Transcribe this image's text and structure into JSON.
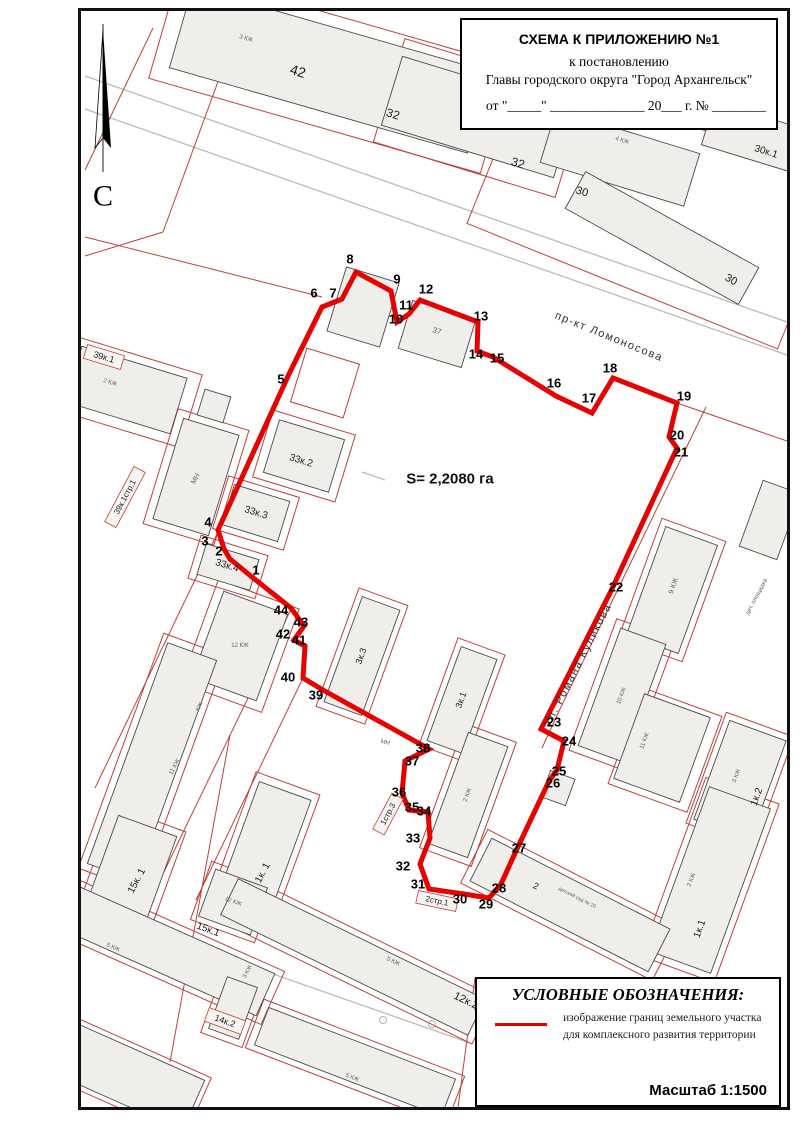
{
  "title_box": {
    "line1": "СХЕМА К ПРИЛОЖЕНИЮ №1",
    "line2": "к постановлению",
    "line3": "Главы городского округа \"Город Архангельск\"",
    "line4": "от \"_____\" ______________ 20___ г. № ________"
  },
  "legend": {
    "heading": "УСЛОВНЫЕ ОБОЗНАЧЕНИЯ:",
    "line1": "изображение границ земельного участка",
    "line2": "для комплексного развития территории",
    "scale": "Масштаб 1:1500"
  },
  "map": {
    "colors": {
      "boundary": "#e60000",
      "parcel": "#c0403a",
      "building_fill": "#f0eeea",
      "street_line": "#bdbab3"
    },
    "area_label": {
      "t": "S= 2,2080 га",
      "x": 450,
      "y": 479
    },
    "north": {
      "label": "С",
      "label_x": 103,
      "label_y": 196,
      "line": [
        103,
        24,
        103,
        172
      ],
      "blade_fill": [
        [
          103,
          30
        ],
        [
          111,
          148
        ],
        [
          103,
          138
        ]
      ],
      "blade_out": [
        [
          103,
          30
        ],
        [
          95,
          148
        ],
        [
          103,
          138
        ]
      ]
    },
    "streets": [
      {
        "t": "пр-кт Ломоносова",
        "x": 609,
        "y": 337,
        "r": 22
      },
      {
        "t": "Ул. Романа Куликова",
        "x": 578,
        "y": 665,
        "r": -63
      }
    ],
    "boundary": {
      "points": [
        [
          252,
          577
        ],
        [
          230,
          559
        ],
        [
          224,
          549
        ],
        [
          218,
          530
        ],
        [
          289,
          374
        ],
        [
          322,
          307
        ],
        [
          342,
          299
        ],
        [
          356,
          272
        ],
        [
          391,
          291
        ],
        [
          397,
          322
        ],
        [
          409,
          314
        ],
        [
          420,
          300
        ],
        [
          478,
          322
        ],
        [
          477,
          351
        ],
        [
          493,
          357
        ],
        [
          556,
          396
        ],
        [
          592,
          413
        ],
        [
          613,
          378
        ],
        [
          677,
          403
        ],
        [
          669,
          437
        ],
        [
          677,
          448
        ],
        [
          611,
          591
        ],
        [
          541,
          729
        ],
        [
          564,
          741
        ],
        [
          557,
          770
        ],
        [
          549,
          781
        ],
        [
          516,
          851
        ],
        [
          501,
          884
        ],
        [
          489,
          898
        ],
        [
          464,
          894
        ],
        [
          429,
          889
        ],
        [
          420,
          864
        ],
        [
          430,
          838
        ],
        [
          428,
          812
        ],
        [
          409,
          810
        ],
        [
          402,
          793
        ],
        [
          405,
          761
        ],
        [
          429,
          749
        ],
        [
          323,
          690
        ],
        [
          303,
          678
        ],
        [
          305,
          646
        ],
        [
          294,
          640
        ],
        [
          304,
          626
        ],
        [
          291,
          608
        ]
      ]
    },
    "vertices": [
      [
        "1",
        256,
        570
      ],
      [
        "2",
        219,
        551
      ],
      [
        "3",
        205,
        541
      ],
      [
        "4",
        208,
        522
      ],
      [
        "5",
        281,
        379
      ],
      [
        "6",
        314,
        293
      ],
      [
        "7",
        333,
        293
      ],
      [
        "8",
        350,
        259
      ],
      [
        "9",
        397,
        279
      ],
      [
        "10",
        396,
        319
      ],
      [
        "11",
        406,
        305
      ],
      [
        "12",
        426,
        289
      ],
      [
        "13",
        481,
        316
      ],
      [
        "14",
        476,
        354
      ],
      [
        "15",
        497,
        358
      ],
      [
        "16",
        554,
        383
      ],
      [
        "17",
        589,
        398
      ],
      [
        "18",
        610,
        368
      ],
      [
        "19",
        684,
        396
      ],
      [
        "20",
        677,
        435
      ],
      [
        "21",
        681,
        452
      ],
      [
        "22",
        616,
        587
      ],
      [
        "23",
        554,
        722
      ],
      [
        "24",
        569,
        741
      ],
      [
        "25",
        559,
        771
      ],
      [
        "26",
        553,
        783
      ],
      [
        "27",
        519,
        848
      ],
      [
        "28",
        499,
        888
      ],
      [
        "29",
        486,
        904
      ],
      [
        "30",
        460,
        899
      ],
      [
        "31",
        418,
        884
      ],
      [
        "32",
        403,
        866
      ],
      [
        "33",
        413,
        838
      ],
      [
        "34",
        424,
        811
      ],
      [
        "35",
        412,
        807
      ],
      [
        "36",
        399,
        792
      ],
      [
        "37",
        412,
        761
      ],
      [
        "38",
        423,
        748
      ],
      [
        "39",
        316,
        695
      ],
      [
        "40",
        288,
        677
      ],
      [
        "41",
        299,
        640
      ],
      [
        "42",
        283,
        634
      ],
      [
        "43",
        301,
        622
      ],
      [
        "44",
        281,
        610
      ]
    ],
    "buildings": [
      [
        330,
        70,
        310,
        84,
        16
      ],
      [
        478,
        117,
        180,
        72,
        17
      ],
      [
        620,
        158,
        150,
        55,
        17
      ],
      [
        662,
        238,
        198,
        42,
        29
      ],
      [
        763,
        140,
        115,
        45,
        17
      ],
      [
        126,
        390,
        110,
        58,
        17
      ],
      [
        196,
        477,
        58,
        105,
        17
      ],
      [
        214,
        406,
        27,
        27,
        17
      ],
      [
        363,
        307,
        55,
        67,
        17
      ],
      [
        437,
        334,
        66,
        50,
        17
      ],
      [
        304,
        456,
        68,
        55,
        17
      ],
      [
        256,
        513,
        58,
        42,
        17
      ],
      [
        228,
        567,
        55,
        32,
        17
      ],
      [
        240,
        646,
        68,
        92,
        20
      ],
      [
        362,
        656,
        40,
        112,
        20
      ],
      [
        462,
        700,
        38,
        100,
        20
      ],
      [
        468,
        795,
        42,
        118,
        20
      ],
      [
        152,
        762,
        52,
        235,
        20
      ],
      [
        128,
        880,
        62,
        115,
        20
      ],
      [
        263,
        852,
        55,
        130,
        20
      ],
      [
        233,
        902,
        55,
        50,
        20
      ],
      [
        165,
        950,
        220,
        46,
        24
      ],
      [
        125,
        1075,
        150,
        55,
        24
      ],
      [
        353,
        957,
        275,
        40,
        26
      ],
      [
        355,
        1062,
        200,
        40,
        21
      ],
      [
        233,
        1008,
        32,
        55,
        20
      ],
      [
        672,
        590,
        55,
        115,
        20
      ],
      [
        622,
        695,
        48,
        125,
        20
      ],
      [
        662,
        748,
        70,
        90,
        20
      ],
      [
        740,
        780,
        60,
        105,
        20
      ],
      [
        710,
        880,
        65,
        175,
        20
      ],
      [
        570,
        905,
        200,
        48,
        27
      ],
      [
        558,
        788,
        26,
        28,
        20
      ],
      [
        770,
        520,
        40,
        70,
        20
      ]
    ],
    "parcels": [
      [
        330,
        72,
        345,
        112,
        16
      ],
      [
        480,
        118,
        190,
        108,
        17
      ],
      [
        655,
        205,
        335,
        175,
        22
      ],
      [
        128,
        392,
        132,
        76,
        17
      ],
      [
        304,
        456,
        86,
        70,
        17
      ],
      [
        256,
        513,
        74,
        55,
        17
      ],
      [
        228,
        567,
        70,
        45,
        17
      ],
      [
        325,
        383,
        55,
        56,
        17
      ],
      [
        196,
        477,
        74,
        120,
        17
      ],
      [
        240,
        646,
        86,
        110,
        20
      ],
      [
        362,
        656,
        52,
        126,
        20
      ],
      [
        462,
        700,
        50,
        114,
        20
      ],
      [
        468,
        795,
        55,
        132,
        20
      ],
      [
        152,
        762,
        66,
        250,
        20
      ],
      [
        128,
        880,
        76,
        130,
        20
      ],
      [
        263,
        852,
        68,
        146,
        20
      ],
      [
        233,
        902,
        68,
        62,
        20
      ],
      [
        165,
        950,
        236,
        58,
        24
      ],
      [
        353,
        957,
        290,
        52,
        26
      ],
      [
        355,
        1062,
        215,
        52,
        21
      ],
      [
        233,
        1008,
        44,
        68,
        20
      ],
      [
        672,
        590,
        68,
        128,
        20
      ],
      [
        622,
        695,
        62,
        140,
        20
      ],
      [
        665,
        750,
        84,
        102,
        20
      ],
      [
        740,
        780,
        72,
        118,
        20
      ],
      [
        710,
        880,
        78,
        190,
        20
      ],
      [
        570,
        905,
        215,
        60,
        27
      ],
      [
        125,
        1075,
        160,
        65,
        24
      ]
    ],
    "red_lines": [
      [
        85,
        170,
        153,
        28
      ],
      [
        163,
        232,
        231,
        46
      ],
      [
        85,
        256,
        163,
        232
      ],
      [
        85,
        237,
        322,
        297
      ],
      [
        677,
        403,
        787,
        441
      ],
      [
        706,
        407,
        560,
        709
      ],
      [
        560,
        709,
        542,
        748
      ],
      [
        218,
        532,
        95,
        788
      ],
      [
        291,
        609,
        160,
        880
      ],
      [
        303,
        678,
        196,
        900
      ],
      [
        230,
        735,
        170,
        1062
      ],
      [
        475,
        978,
        458,
        1108
      ]
    ],
    "grey_lines": [
      [
        85,
        76,
        787,
        322
      ],
      [
        85,
        109,
        787,
        355
      ],
      [
        85,
        908,
        470,
        1043
      ],
      [
        362,
        472,
        385,
        480
      ]
    ],
    "marks": [
      [
        383,
        1020
      ],
      [
        432,
        1024
      ],
      [
        478,
        1008
      ]
    ],
    "labels": [
      [
        "42",
        298,
        71,
        17,
        14,
        "b"
      ],
      [
        "32",
        393,
        114,
        17,
        12,
        "b"
      ],
      [
        "32",
        518,
        163,
        17,
        12,
        "b"
      ],
      [
        "30",
        582,
        192,
        17,
        11,
        "b"
      ],
      [
        "30",
        731,
        280,
        29,
        11,
        "b"
      ],
      [
        "30к.1",
        766,
        152,
        17,
        10,
        "b"
      ],
      [
        "4 КЖ",
        622,
        141,
        17,
        6,
        "g"
      ],
      [
        "3 КЖ",
        246,
        39,
        16,
        6,
        "g"
      ],
      [
        "2 КЖ",
        110,
        383,
        17,
        6,
        "g"
      ],
      [
        "39к.1",
        104,
        357,
        17,
        9,
        "x"
      ],
      [
        "39к.1стр.1",
        125,
        497,
        -62,
        8,
        "x"
      ],
      [
        "МН",
        196,
        479,
        -62,
        7,
        "g"
      ],
      [
        "33к.2",
        301,
        461,
        17,
        10,
        "b"
      ],
      [
        "33к.3",
        256,
        513,
        17,
        10,
        "b"
      ],
      [
        "33к.4",
        227,
        566,
        17,
        10,
        "b"
      ],
      [
        "3к.3",
        361,
        656,
        -70,
        9,
        "b"
      ],
      [
        "3к.1",
        461,
        700,
        -70,
        9,
        "b"
      ],
      [
        "2 КЖ",
        468,
        795,
        -70,
        6,
        "g"
      ],
      [
        "12 КЖ",
        240,
        646,
        0,
        6,
        "g"
      ],
      [
        "КЖ",
        200,
        707,
        -62,
        6,
        "g"
      ],
      [
        "11 КЖ",
        175,
        767,
        -62,
        6,
        "g"
      ],
      [
        "15к. 1",
        137,
        881,
        -62,
        10,
        "b"
      ],
      [
        "1к. 1",
        263,
        873,
        -62,
        10,
        "b"
      ],
      [
        "12 КЖ",
        233,
        902,
        20,
        6,
        "g"
      ],
      [
        "15к.1",
        208,
        930,
        20,
        10,
        "b"
      ],
      [
        "5 КЖ",
        113,
        948,
        24,
        6,
        "g"
      ],
      [
        "5 КЖ",
        393,
        962,
        26,
        6,
        "g"
      ],
      [
        "12к.2",
        466,
        1001,
        26,
        11,
        "b"
      ],
      [
        "5 КЖ",
        352,
        1078,
        21,
        6,
        "g"
      ],
      [
        "3 КЖ",
        248,
        972,
        -62,
        6,
        "g"
      ],
      [
        "14к.2",
        225,
        1021,
        20,
        9,
        "x"
      ],
      [
        "9 КЖ",
        674,
        586,
        -70,
        7,
        "g"
      ],
      [
        "дет. площадка",
        757,
        597,
        -62,
        6,
        "g"
      ],
      [
        "10 КЖ",
        622,
        696,
        -70,
        6,
        "g"
      ],
      [
        "11 КЖ",
        645,
        741,
        -70,
        6,
        "g"
      ],
      [
        "3 КЖ",
        737,
        776,
        -70,
        6,
        "g"
      ],
      [
        "1к.2",
        757,
        797,
        -70,
        10,
        "b"
      ],
      [
        "2 КЖ",
        692,
        880,
        -70,
        6,
        "g"
      ],
      [
        "1к.1",
        700,
        929,
        -70,
        10,
        "b"
      ],
      [
        "2",
        536,
        886,
        27,
        9,
        "b"
      ],
      [
        "детский сад № 20",
        577,
        898,
        27,
        5,
        "g"
      ],
      [
        "1стр.3",
        388,
        814,
        -62,
        8,
        "x"
      ],
      [
        "2стр.1",
        437,
        901,
        12,
        8,
        "x"
      ],
      [
        "МН",
        385,
        743,
        17,
        6,
        "g"
      ],
      [
        "н.с.",
        434,
        889,
        0,
        5,
        "g"
      ],
      [
        "37",
        437,
        331,
        17,
        8,
        "g"
      ]
    ]
  }
}
